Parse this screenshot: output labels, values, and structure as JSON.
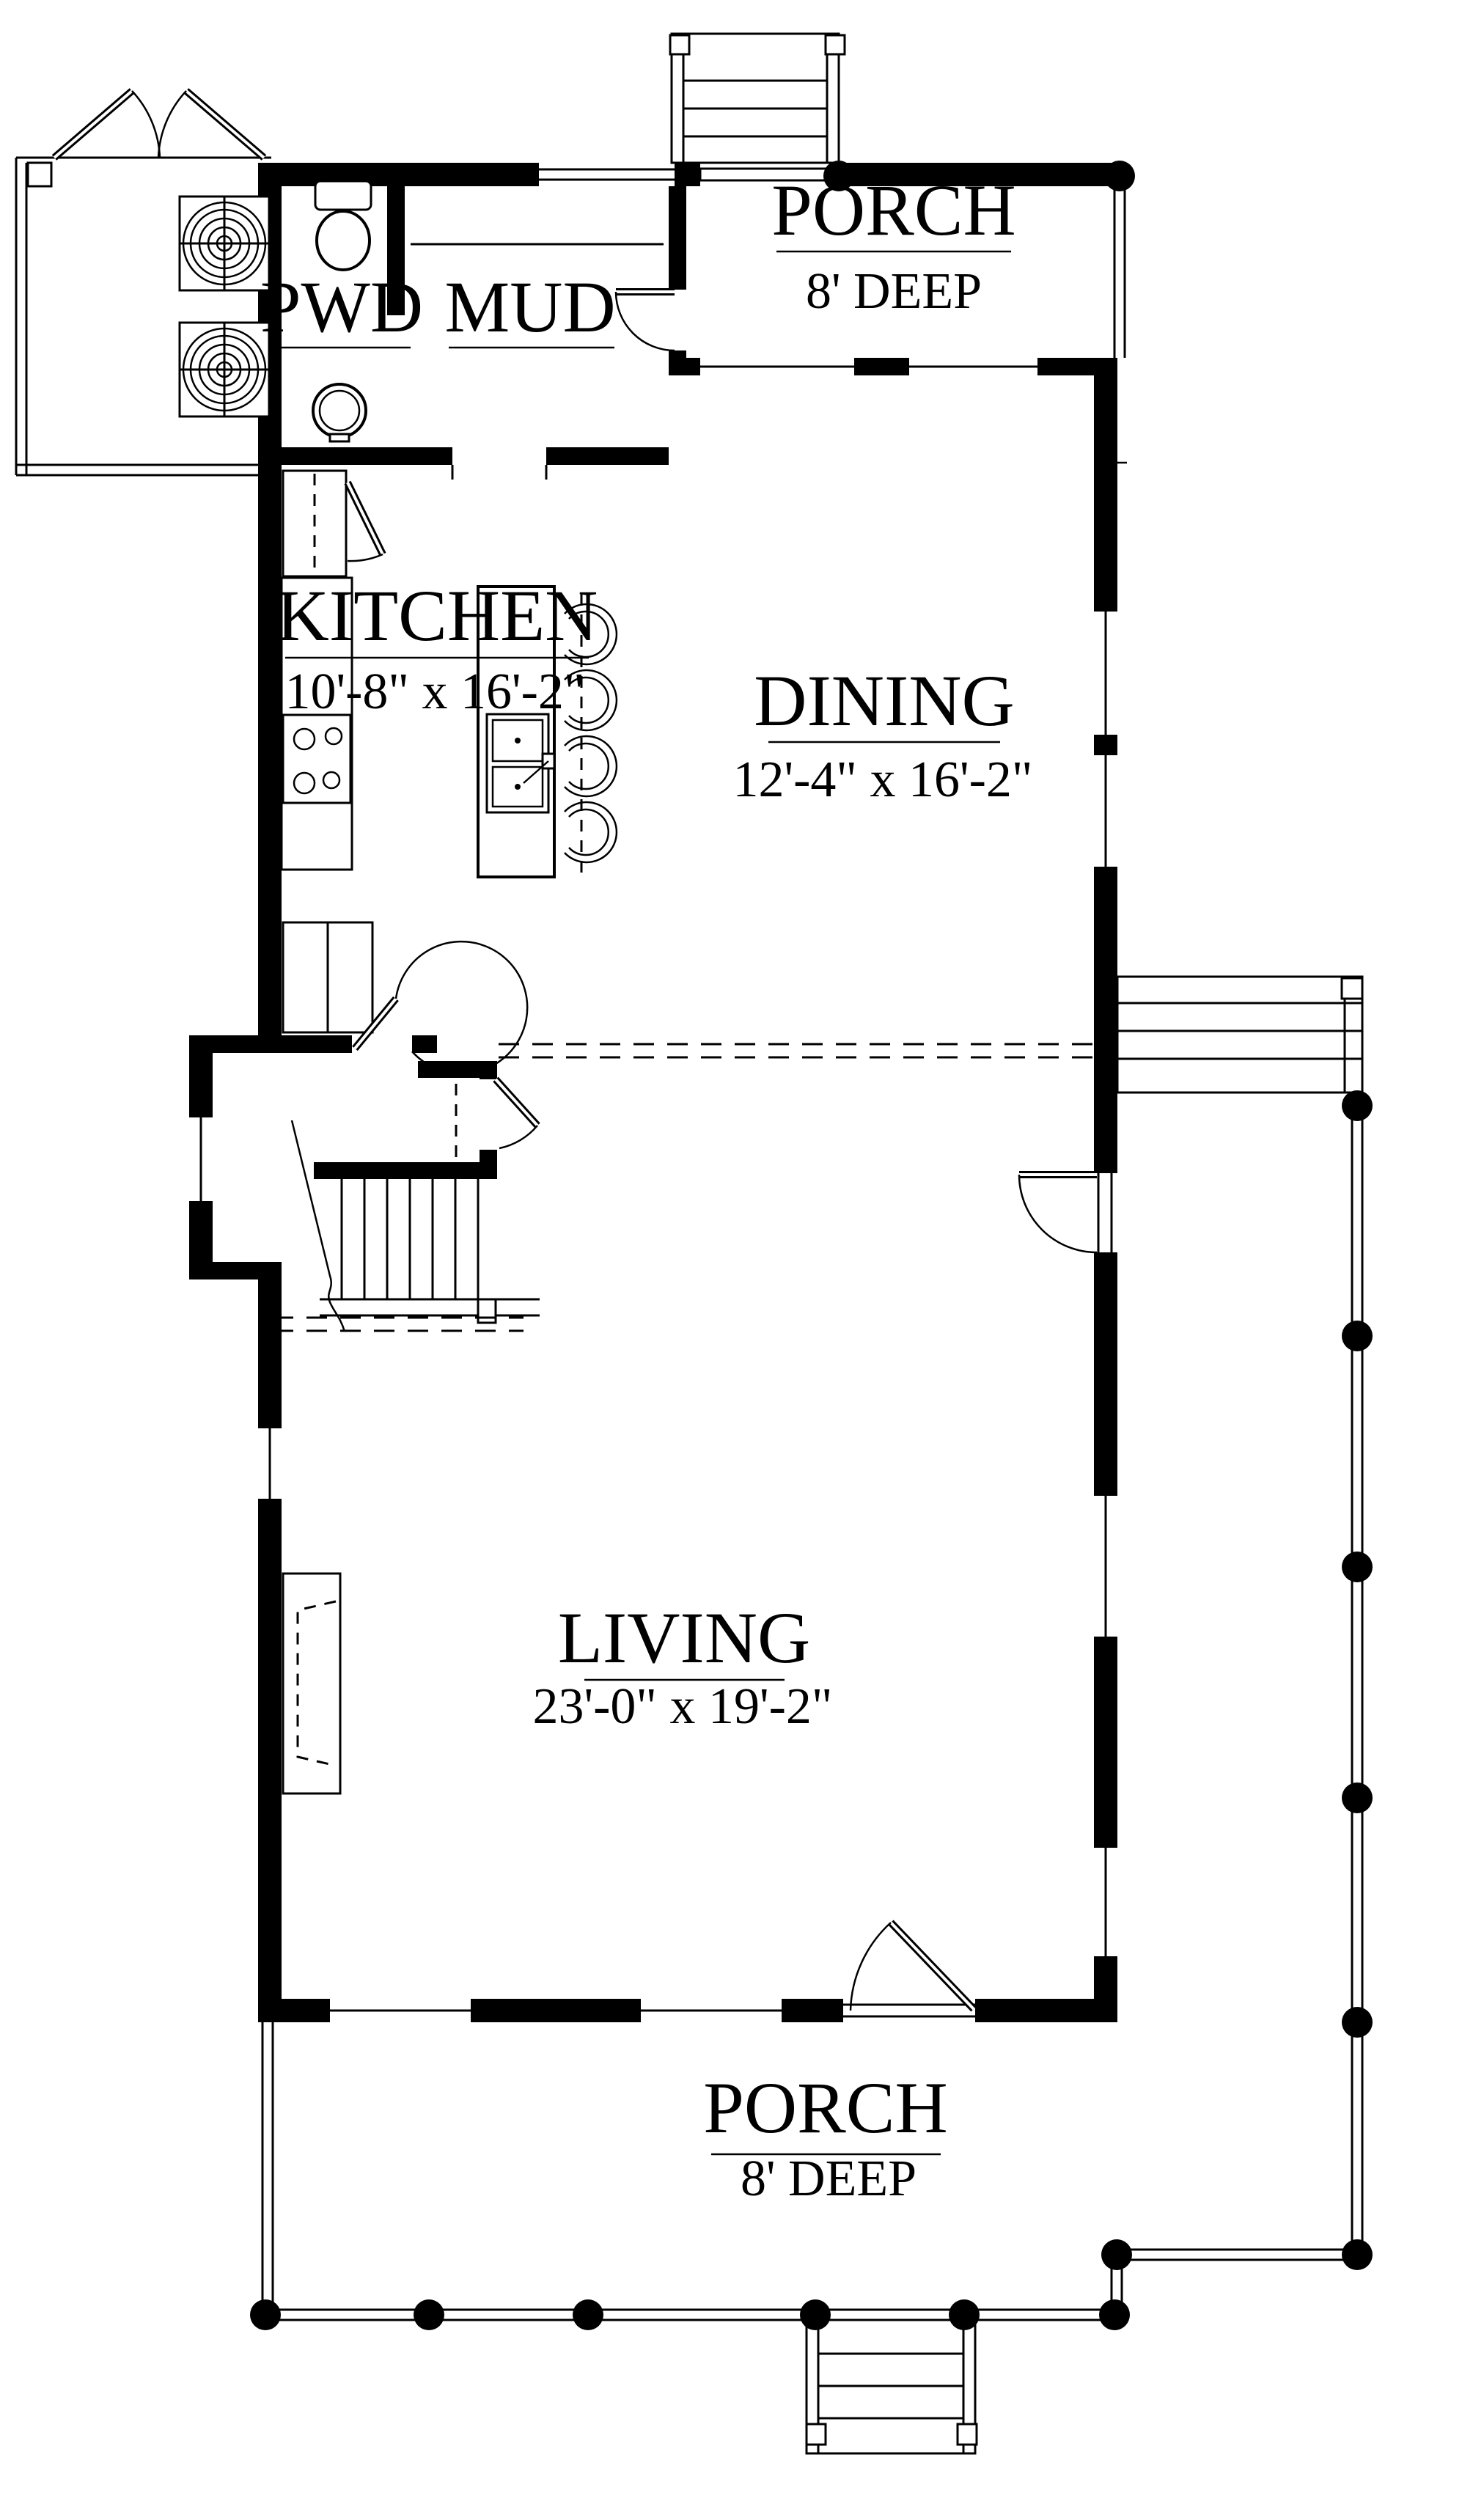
{
  "title": "First floor plan",
  "colors": {
    "ink": "#000000",
    "paper": "#ffffff"
  },
  "labels": {
    "pwd": {
      "name": "PWD"
    },
    "mud": {
      "name": "MUD"
    },
    "kitchen": {
      "name": "KITCHEN",
      "dims": "10'-8\" x 16'-2\""
    },
    "dining": {
      "name": "DINING",
      "dims": "12'-4\" x 16'-2\""
    },
    "living": {
      "name": "LIVING",
      "dims": "23'-0\" x 19'-2\""
    },
    "porch_top": {
      "name": "PORCH",
      "dims": "8' DEEP"
    },
    "porch_bottom": {
      "name": "PORCH",
      "dims": "8' DEEP"
    }
  },
  "fixture_icons": [
    "toilet-icon",
    "pedestal-sink-icon",
    "hvac-unit-icon",
    "hvac-unit-icon",
    "range-icon",
    "island-sink-icon",
    "bar-stool-icon",
    "refrigerator-icon",
    "pantry-icon",
    "closet-rod-icon",
    "fireplace-icon",
    "stairs-icon",
    "door-swing-icon",
    "porch-column-icon",
    "railing-icon",
    "steps-icon"
  ]
}
